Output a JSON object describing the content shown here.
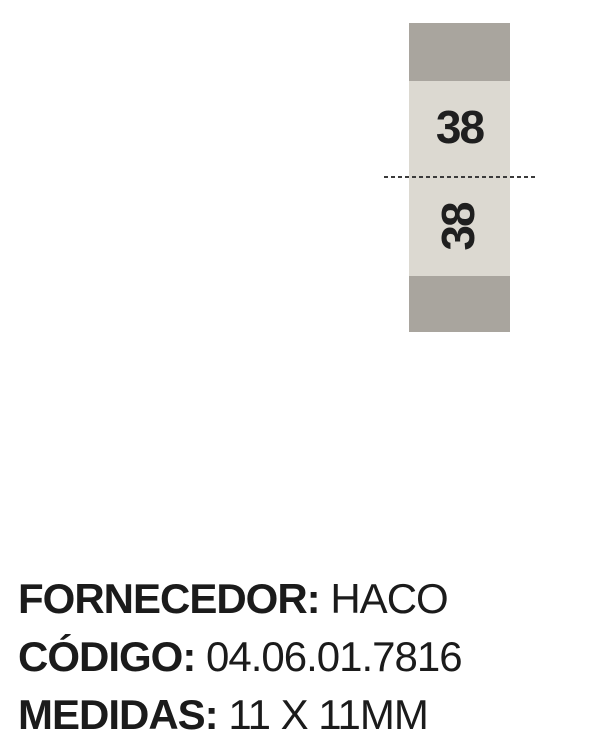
{
  "label_tag": {
    "size_front": "38",
    "size_back": "38",
    "band_color": "#a9a59e",
    "body_color": "#dcd9d1",
    "digit_color": "#1f1f1f",
    "fold_line_color": "#3b3b3b"
  },
  "product_info": {
    "text_color": "#1b1b1b",
    "rows": [
      {
        "label": "FORNECEDOR:",
        "value": "HACO"
      },
      {
        "label": "CÓDIGO:",
        "value": "04.06.01.7816"
      },
      {
        "label": "MEDIDAS:",
        "value": "11 X 11MM"
      }
    ]
  }
}
